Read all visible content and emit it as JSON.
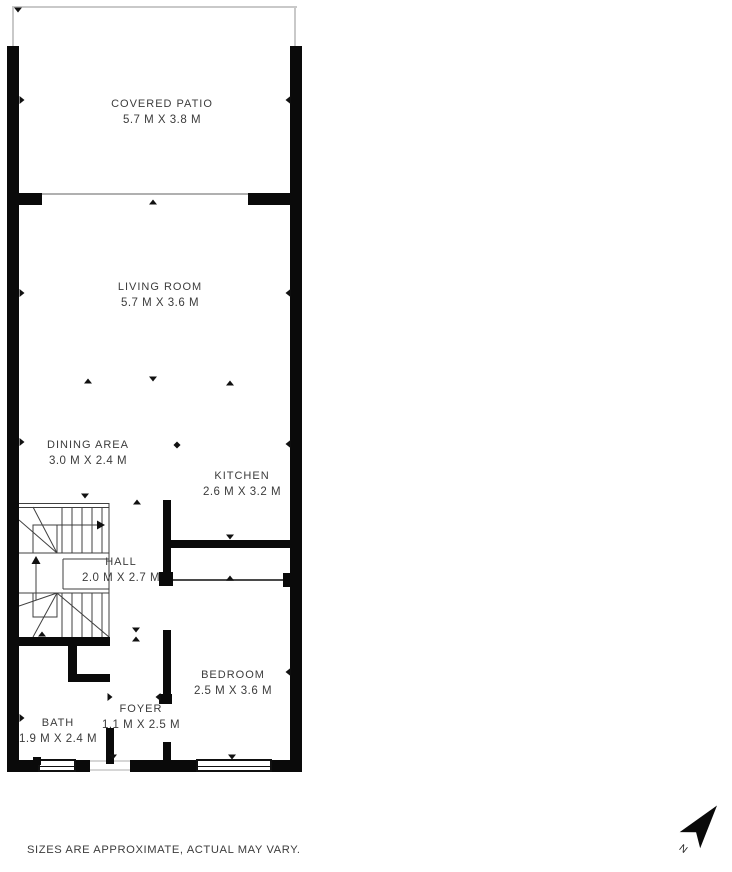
{
  "plan": {
    "rooms": [
      {
        "id": "covered-patio",
        "name": "COVERED PATIO",
        "dims": "5.7 M X 3.8 M"
      },
      {
        "id": "living-room",
        "name": "LIVING ROOM",
        "dims": "5.7 M X 3.6 M"
      },
      {
        "id": "dining-area",
        "name": "DINING AREA",
        "dims": "3.0 M X 2.4 M"
      },
      {
        "id": "kitchen",
        "name": "KITCHEN",
        "dims": "2.6 M X 3.2 M"
      },
      {
        "id": "hall",
        "name": "HALL",
        "dims": "2.0 M X 2.7 M"
      },
      {
        "id": "bedroom",
        "name": "BEDROOM",
        "dims": "2.5 M X 3.6 M"
      },
      {
        "id": "bath",
        "name": "BATH",
        "dims": "1.9 M X 2.4 M"
      },
      {
        "id": "foyer",
        "name": "FOYER",
        "dims": "1.1 M X 2.5 M"
      }
    ],
    "compass": {
      "label": "N"
    },
    "disclaimer": "SIZES ARE APPROXIMATE, ACTUAL MAY VARY.",
    "colors": {
      "wall": "#0a0a0a",
      "text": "#3c3c3c",
      "stair_line": "#3f3f3f",
      "patio_outline": "#c9c9c9"
    },
    "markers": [
      {
        "x": 18,
        "y": 10,
        "d": "down"
      },
      {
        "x": 22,
        "y": 100,
        "d": "right"
      },
      {
        "x": 288,
        "y": 100,
        "d": "left"
      },
      {
        "x": 153,
        "y": 202,
        "d": "up"
      },
      {
        "x": 22,
        "y": 293,
        "d": "right"
      },
      {
        "x": 288,
        "y": 293,
        "d": "left"
      },
      {
        "x": 88,
        "y": 381,
        "d": "up"
      },
      {
        "x": 153,
        "y": 379,
        "d": "down"
      },
      {
        "x": 230,
        "y": 383,
        "d": "up"
      },
      {
        "x": 22,
        "y": 442,
        "d": "right"
      },
      {
        "x": 288,
        "y": 444,
        "d": "left"
      },
      {
        "x": 177,
        "y": 445,
        "d": "diamond"
      },
      {
        "x": 85,
        "y": 496,
        "d": "down"
      },
      {
        "x": 137,
        "y": 502,
        "d": "up"
      },
      {
        "x": 230,
        "y": 537,
        "d": "down"
      },
      {
        "x": 230,
        "y": 578,
        "d": "up"
      },
      {
        "x": 42,
        "y": 634,
        "d": "up"
      },
      {
        "x": 136,
        "y": 630,
        "d": "down"
      },
      {
        "x": 136,
        "y": 639,
        "d": "up"
      },
      {
        "x": 288,
        "y": 672,
        "d": "left"
      },
      {
        "x": 110,
        "y": 697,
        "d": "right"
      },
      {
        "x": 158,
        "y": 697,
        "d": "left"
      },
      {
        "x": 22,
        "y": 718,
        "d": "right"
      },
      {
        "x": 113,
        "y": 757,
        "d": "down"
      },
      {
        "x": 232,
        "y": 757,
        "d": "down"
      }
    ]
  }
}
